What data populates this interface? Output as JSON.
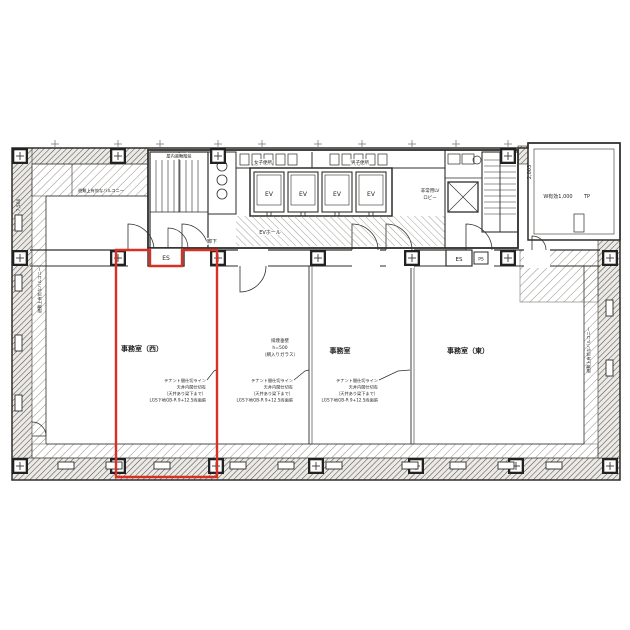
{
  "palette": {
    "line": "#2e2d2b",
    "accent_red": "#d93025",
    "hatch": "#8a867f"
  },
  "rooms": {
    "west": "事務室（西）",
    "center": "事務室",
    "east": "事務室（東）"
  },
  "core": {
    "stair_label": "屋内避難階段",
    "wc_women": "女子便所",
    "wc_men": "男子便所",
    "ev": "EV",
    "ev_hall": "EVホール",
    "emergency_lv_1": "非常用LV",
    "emergency_lv_2": "ロビー",
    "corridor": "廊下",
    "es_west": "ES",
    "es_east": "ES",
    "ps": "PS"
  },
  "terrace": {
    "depth_dim": "2,003",
    "width_label": "W有効1,000",
    "tp": "TP"
  },
  "notes": {
    "balcony": "避難上有効なバルコニー",
    "smoke_1": "排煙垂壁",
    "smoke_2": "h=500",
    "smoke_3": "（網入りガラス）",
    "tenant_1": "テナント間仕切ライン",
    "tenant_2": "天井内間仕切有",
    "tenant_3": "（天井あり梁下まで）",
    "tenant_4": "LGS下地GB-R 9+12.5両面張",
    "dim_left": "7,500"
  }
}
